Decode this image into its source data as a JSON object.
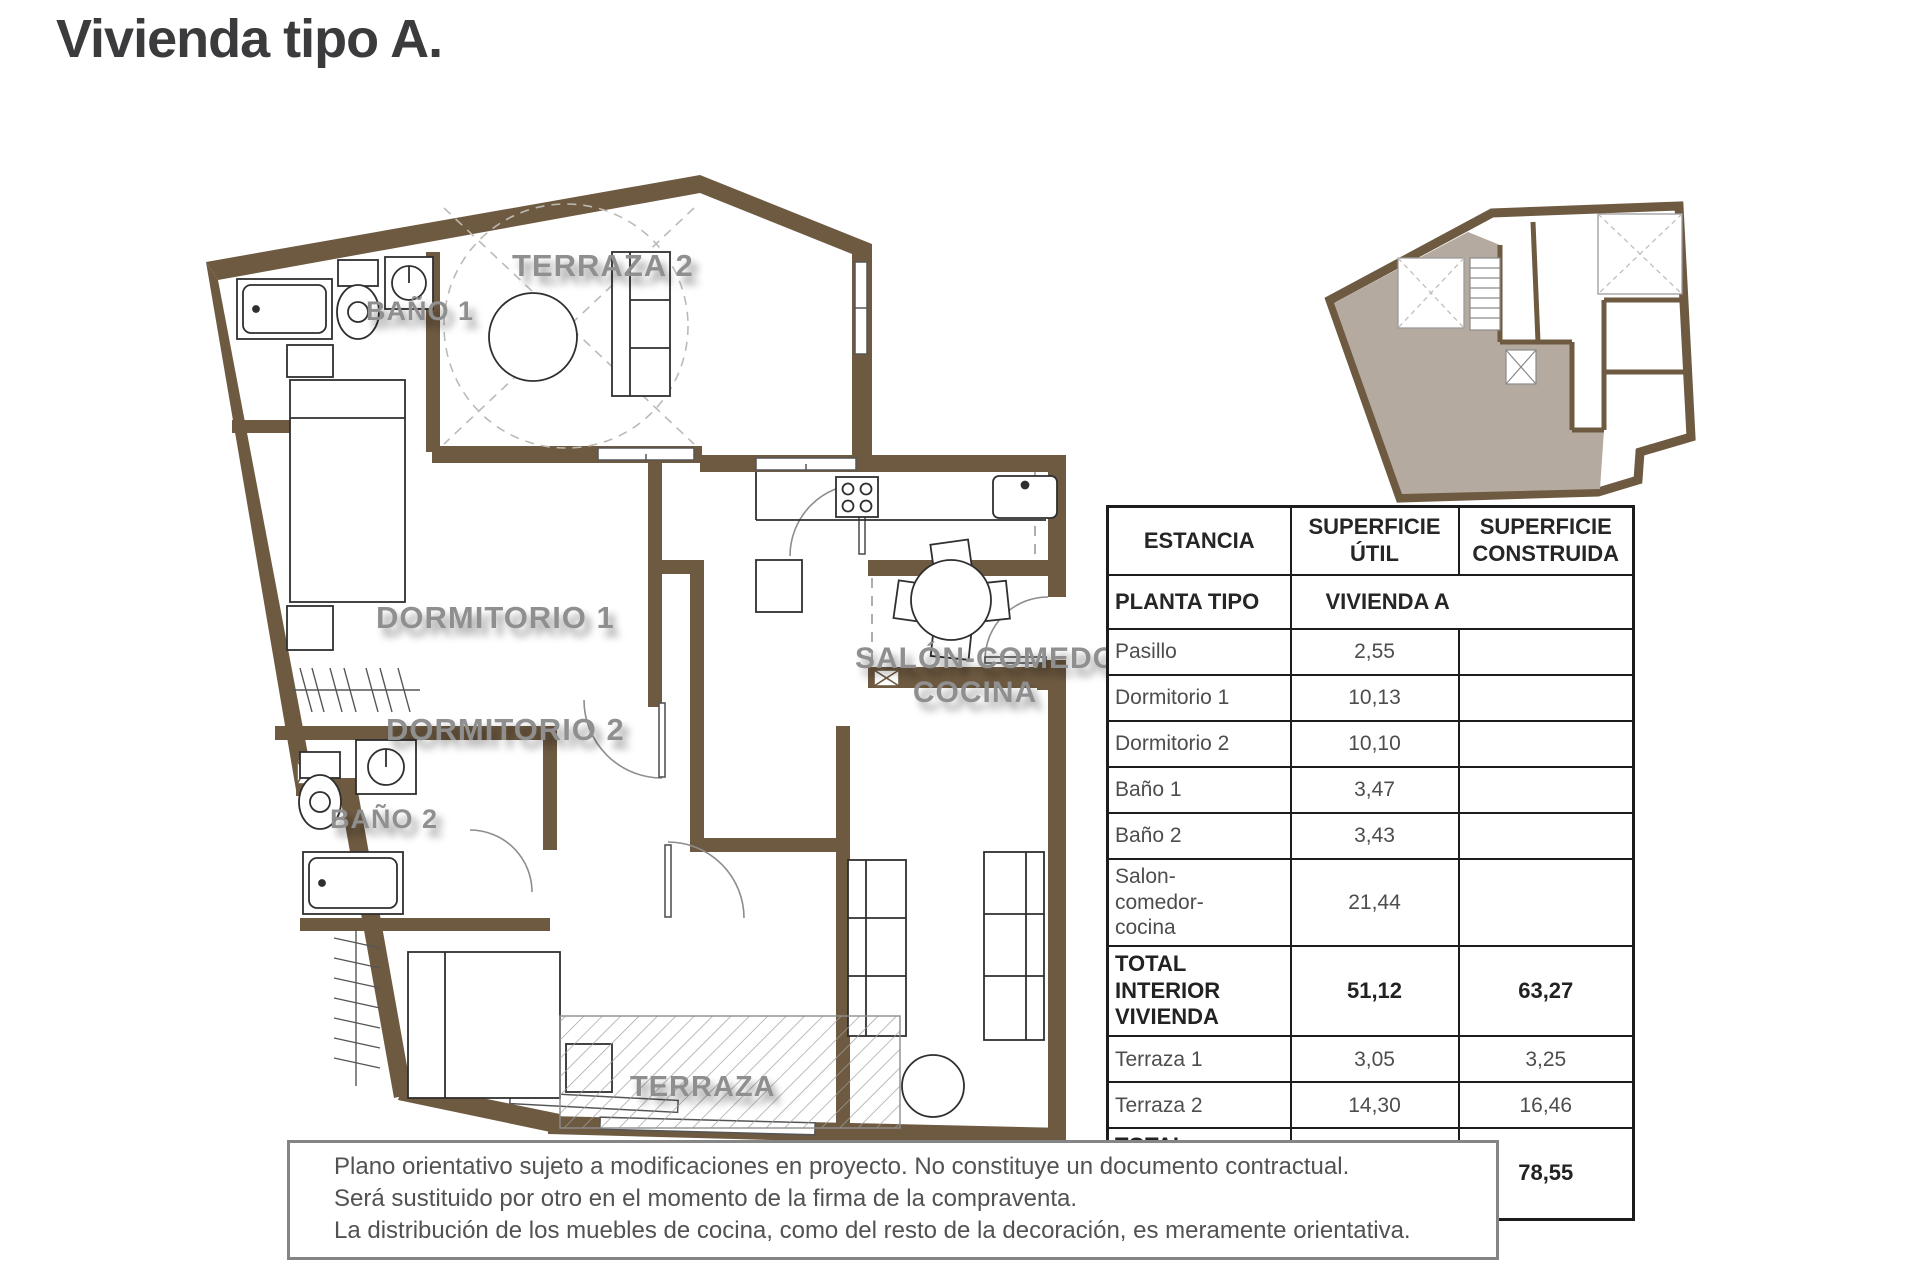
{
  "page": {
    "title": "Vivienda tipo A."
  },
  "plan": {
    "labels": {
      "terraza2": "TERRAZA 2",
      "bano1": "BAÑO 1",
      "dormitorio1": "DORMITORIO 1",
      "bano2": "BAÑO 2",
      "dormitorio2": "DORMITORIO 2",
      "salon_line1": "SALÓN-COMEDOR",
      "salon_line2": "COCINA",
      "terraza": "TERRAZA"
    },
    "colors": {
      "wall_brown": "#6e5a41",
      "label_gray": "#8f8f8f",
      "keyplan_unit_highlight": "#b4aaa0"
    }
  },
  "table": {
    "headers": [
      "ESTANCIA",
      "SUPERFICIE\nÚTIL",
      "SUPERFICIE\nCONSTRUIDA"
    ],
    "subheader": {
      "col1": "PLANTA TIPO",
      "col2": "VIVIENDA A"
    },
    "rows": [
      {
        "label": "Pasillo",
        "util": "2,55",
        "construida": "",
        "bold": false
      },
      {
        "label": "Dormitorio 1",
        "util": "10,13",
        "construida": "",
        "bold": false
      },
      {
        "label": "Dormitorio 2",
        "util": "10,10",
        "construida": "",
        "bold": false
      },
      {
        "label": "Baño 1",
        "util": "3,47",
        "construida": "",
        "bold": false
      },
      {
        "label": "Baño 2",
        "util": "3,43",
        "construida": "",
        "bold": false
      },
      {
        "label": "Salon-\ncomedor-\ncocina",
        "util": "21,44",
        "construida": "",
        "bold": false
      },
      {
        "label": "TOTAL INTERIOR\nVIVIENDA",
        "util": "51,12",
        "construida": "63,27",
        "bold": true
      },
      {
        "label": "Terraza 1",
        "util": "3,05",
        "construida": "3,25",
        "bold": false
      },
      {
        "label": "Terraza 2",
        "util": "14,30",
        "construida": "16,46",
        "bold": false
      },
      {
        "label": "TOTAL VIVIENDA\n+ TERRAZAS",
        "util": "65,84",
        "construida": "78,55",
        "bold": true
      }
    ]
  },
  "disclaimer": {
    "lines": [
      "Plano orientativo sujeto a modificaciones en proyecto. No constituye un documento contractual.",
      "Será sustituido por otro en el momento de la firma de la compraventa.",
      "La distribución de los muebles de cocina, como del resto de la decoración, es meramente orientativa."
    ]
  }
}
